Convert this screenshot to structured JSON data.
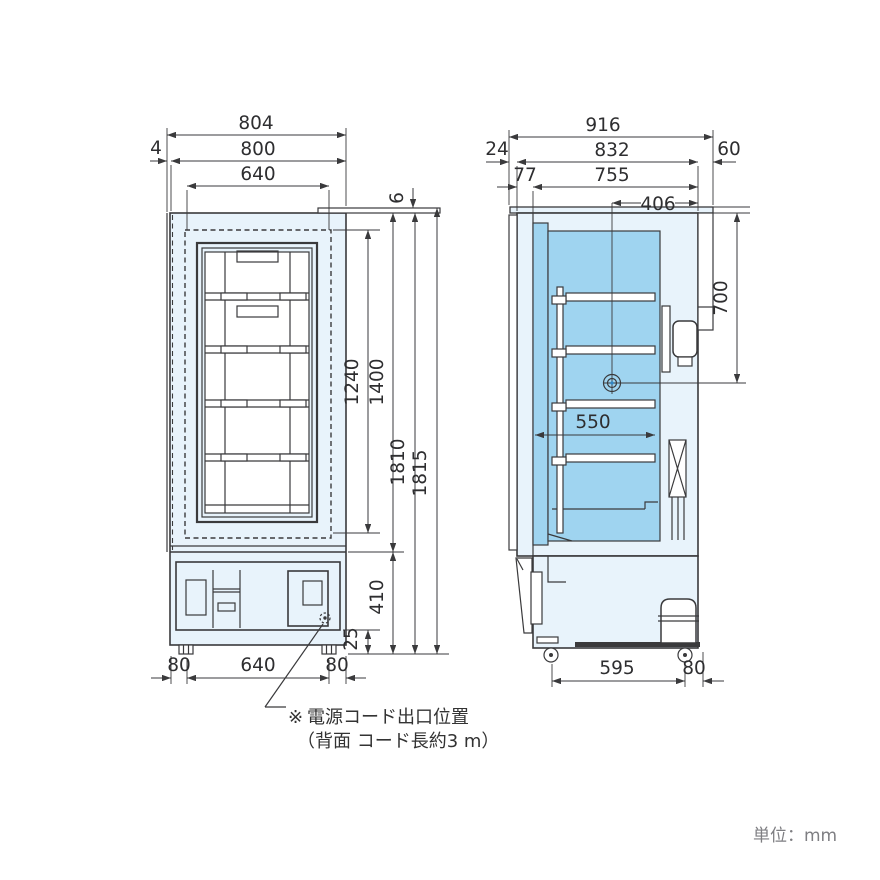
{
  "drawing": {
    "unit_label": "単位：mm",
    "note": {
      "marker": "※",
      "line1": "電源コード出口位置",
      "line2": "（背面 コード長約3 m）"
    },
    "front_view": {
      "label": "front-view",
      "dims": {
        "overall_width": "804",
        "body_width": "800",
        "opening_width": "640",
        "door_side_gap": "4",
        "top_panel_height": "6",
        "opening_height": "1240",
        "door_height": "1400",
        "body_height": "1810",
        "overall_height": "1815",
        "machine_room_height": "410",
        "base_height": "25",
        "leg_offset_left": "80",
        "leg_span": "640",
        "leg_offset_right": "80"
      }
    },
    "side_view": {
      "label": "side-view",
      "dims": {
        "overall_depth": "916",
        "body_depth": "832",
        "rear_gap": "60",
        "front_gap": "24",
        "door_depth": "77",
        "inner_depth": "755",
        "cord_from_back": "406",
        "cord_from_top": "700",
        "shelf_depth": "550",
        "caster_span": "595",
        "caster_rear_offset": "80"
      }
    },
    "colors": {
      "body_fill": "#e8f3fb",
      "chamber_fill": "#9fd4f0",
      "line": "#3a3a3c",
      "note_marker": "#29abe2",
      "unit_text": "#7e7e82"
    }
  }
}
